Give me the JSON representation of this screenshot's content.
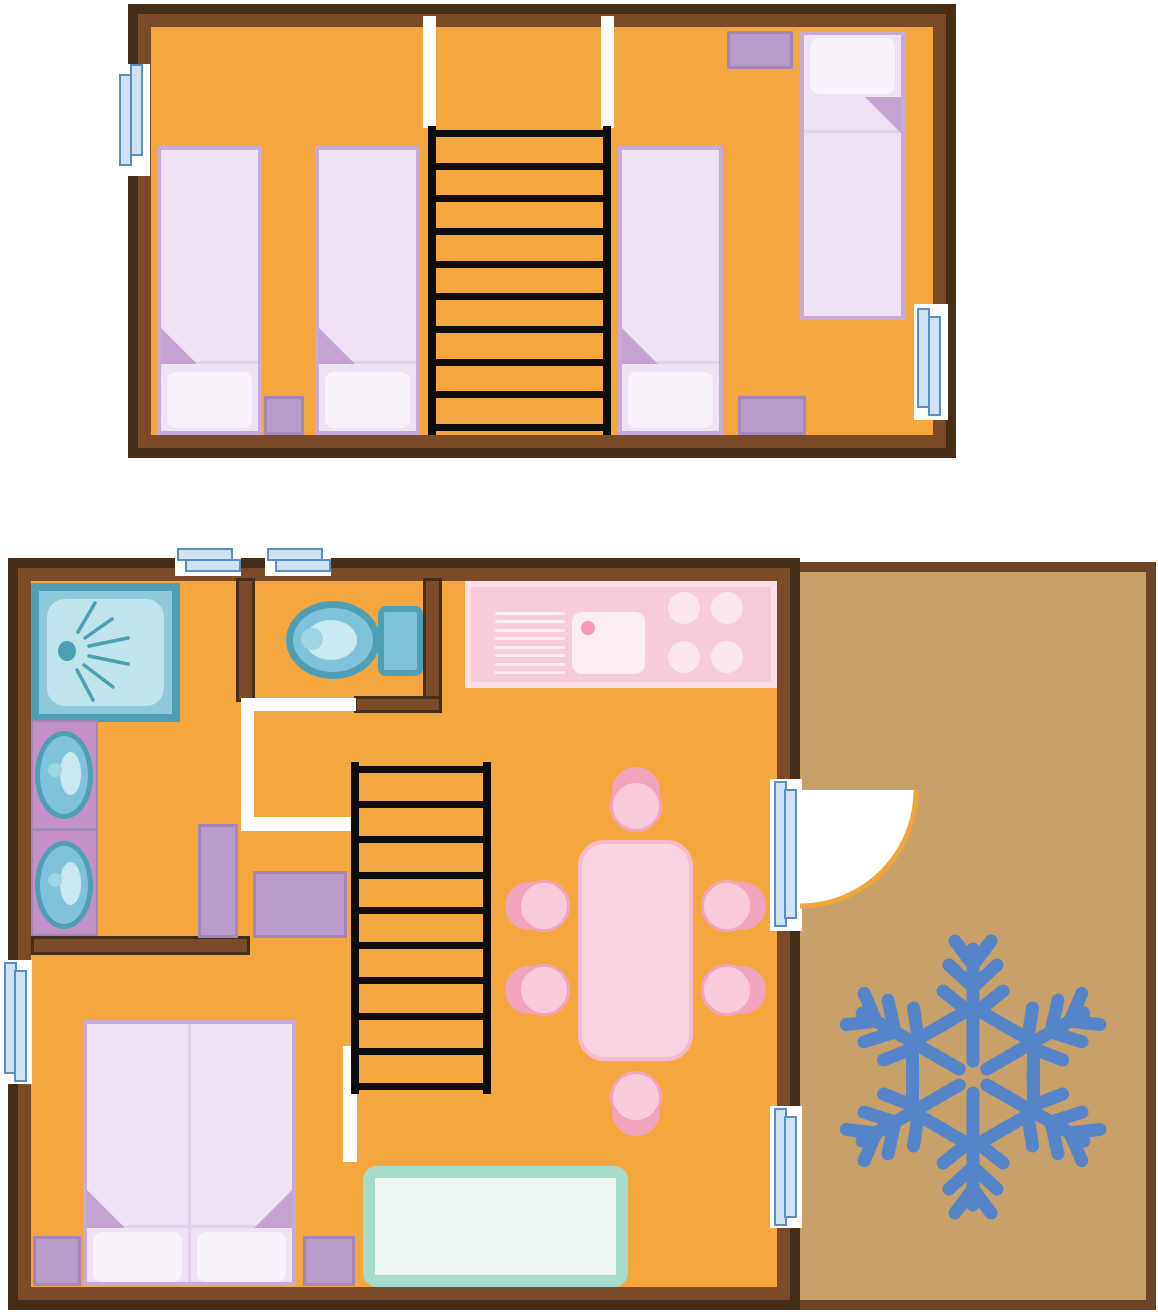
{
  "diagram": {
    "type": "floor-plan",
    "description": "Two-level chalet floor plan: upper sleeping loft with four single beds and ladder stairs; ground floor with shower room, WC, hall, kitchen-living room, double bedroom, and a terrace marked with a snowflake"
  },
  "palette": {
    "floor": "#F4A73E",
    "wall": "#7B4A28",
    "wallDark": "#462D17",
    "terrace": "#C7A169",
    "terraceBorder": "#6B4325",
    "bedBorder": "#C9A9D6",
    "bedFill": "#EFE2F4",
    "bedFold": "#C4A3D2",
    "bedFoldLine": "#E2D2EB",
    "pillow": "#F8F2FA",
    "purple": "#B99CCB",
    "purpleBorder": "#A585BA",
    "vanity": "#C491C6",
    "fixBorder": "#4E9EB4",
    "fixFill": "#7FC3DA",
    "fixLight": "#C8E8F2",
    "fixMid": "#9FD4E4",
    "showerFill": "#8FCADC",
    "showerInner": "#BFE4EE",
    "winFill": "#CFE3F5",
    "winBorder": "#5B8FC4",
    "kitchen": "#F8CBDA",
    "kitchenLight": "#FBDEE8",
    "kitchenPale": "#FCEFF4",
    "burner": "#FBE6EE",
    "kitchenDot": "#F59BB8",
    "table": "#F9D3DF",
    "tableBorder": "#F6BACD",
    "chairSeat": "#F9CBDA",
    "chairBack": "#F2A3BD",
    "sofaBorder": "#A7DCCC",
    "sofaFill": "#EDF7F2",
    "ladder": "#0C0C0C",
    "snowflake": "#5585C8",
    "doorArc": "#F0A43C",
    "white": "#FFFFFF"
  },
  "upper_floor": {
    "single_beds": 4,
    "nightstands": 3,
    "windows": 2,
    "stair_openings": 2,
    "stairs": {
      "rungs": 10
    }
  },
  "ground_floor": {
    "rooms": [
      "shower-room",
      "wc",
      "hall",
      "kitchen-living-room",
      "bedroom"
    ],
    "windows": 3,
    "fixtures": [
      "shower",
      "washbasin",
      "washbasin",
      "toilet",
      "kitchen-counter"
    ],
    "kitchen": {
      "burners": 4,
      "sink": 1,
      "drainer_lines": 8
    },
    "dining": {
      "chairs": 6,
      "table": 1
    },
    "bedroom": {
      "double_bed": 1,
      "nightstands": 2
    },
    "wardrobes": 2,
    "sofa": 1,
    "stairs": {
      "rungs": 10
    },
    "door_to_terrace": {
      "glass_panes": 4,
      "swing": "quarter-circle"
    }
  },
  "terrace": {
    "snowflake_arms": 6
  }
}
